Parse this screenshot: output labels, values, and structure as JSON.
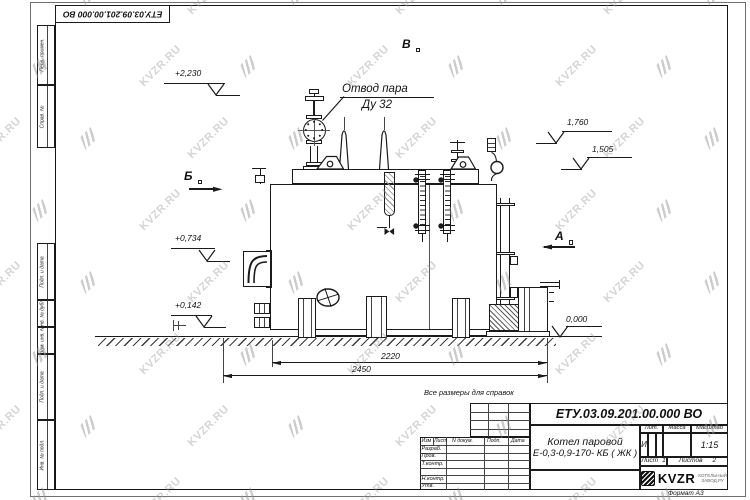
{
  "watermark": {
    "text": "KVZR.RU"
  },
  "corner_stamp": {
    "doc_number": "ЕТУ.03.09.201.00.000  ВО"
  },
  "margin_stamps": [
    "Перв. примен.",
    "Справ. №",
    "Подп. и дата",
    "Инв. № дубл.",
    "Взам. инв. №",
    "Подп. и дата",
    "Инв. № подл."
  ],
  "drawing": {
    "labels": {
      "steam_outlet_line1": "Отвод пара",
      "steam_outlet_line2": "Ду 32",
      "reference_note": "Все размеры для справок"
    },
    "elevations": {
      "top": "+2,230",
      "right_upper": "1,760",
      "right_mid": "1,505",
      "left_mid": "+0,734",
      "left_low": "+0,142",
      "ground": "0,000"
    },
    "sections": {
      "b": "Б",
      "a": "А",
      "v": "В"
    },
    "dimensions": {
      "inner": "2220",
      "outer": "2450"
    }
  },
  "title_block": {
    "doc_number": "ЕТУ.03.09.201.00.000  ВО",
    "product_name_line1": "Котел паровой",
    "product_name_line2": "Е-0,3-0,9-170- КБ ( ЖК )",
    "headers": {
      "lit": "Лит.",
      "mass": "Масса",
      "scale": "Масштаб"
    },
    "values": {
      "lit": "И",
      "scale": "1:15"
    },
    "sheet": {
      "sheet_label": "Лист",
      "sheet_no": "1",
      "sheets_label": "Листов",
      "sheets_total": "2"
    },
    "columns": [
      "Изм",
      "Лист",
      "N докум.",
      "Подп.",
      "Дата"
    ],
    "rows": [
      "Разраб.",
      "Пров.",
      "Т.контр.",
      "",
      "Н.контр.",
      "Утв."
    ],
    "logo": {
      "text": "KVZR",
      "sub_line1": "КОТЕЛЬНЫЙ",
      "sub_line2": "ЗАВОД.РУ"
    },
    "format": "Формат А3"
  }
}
